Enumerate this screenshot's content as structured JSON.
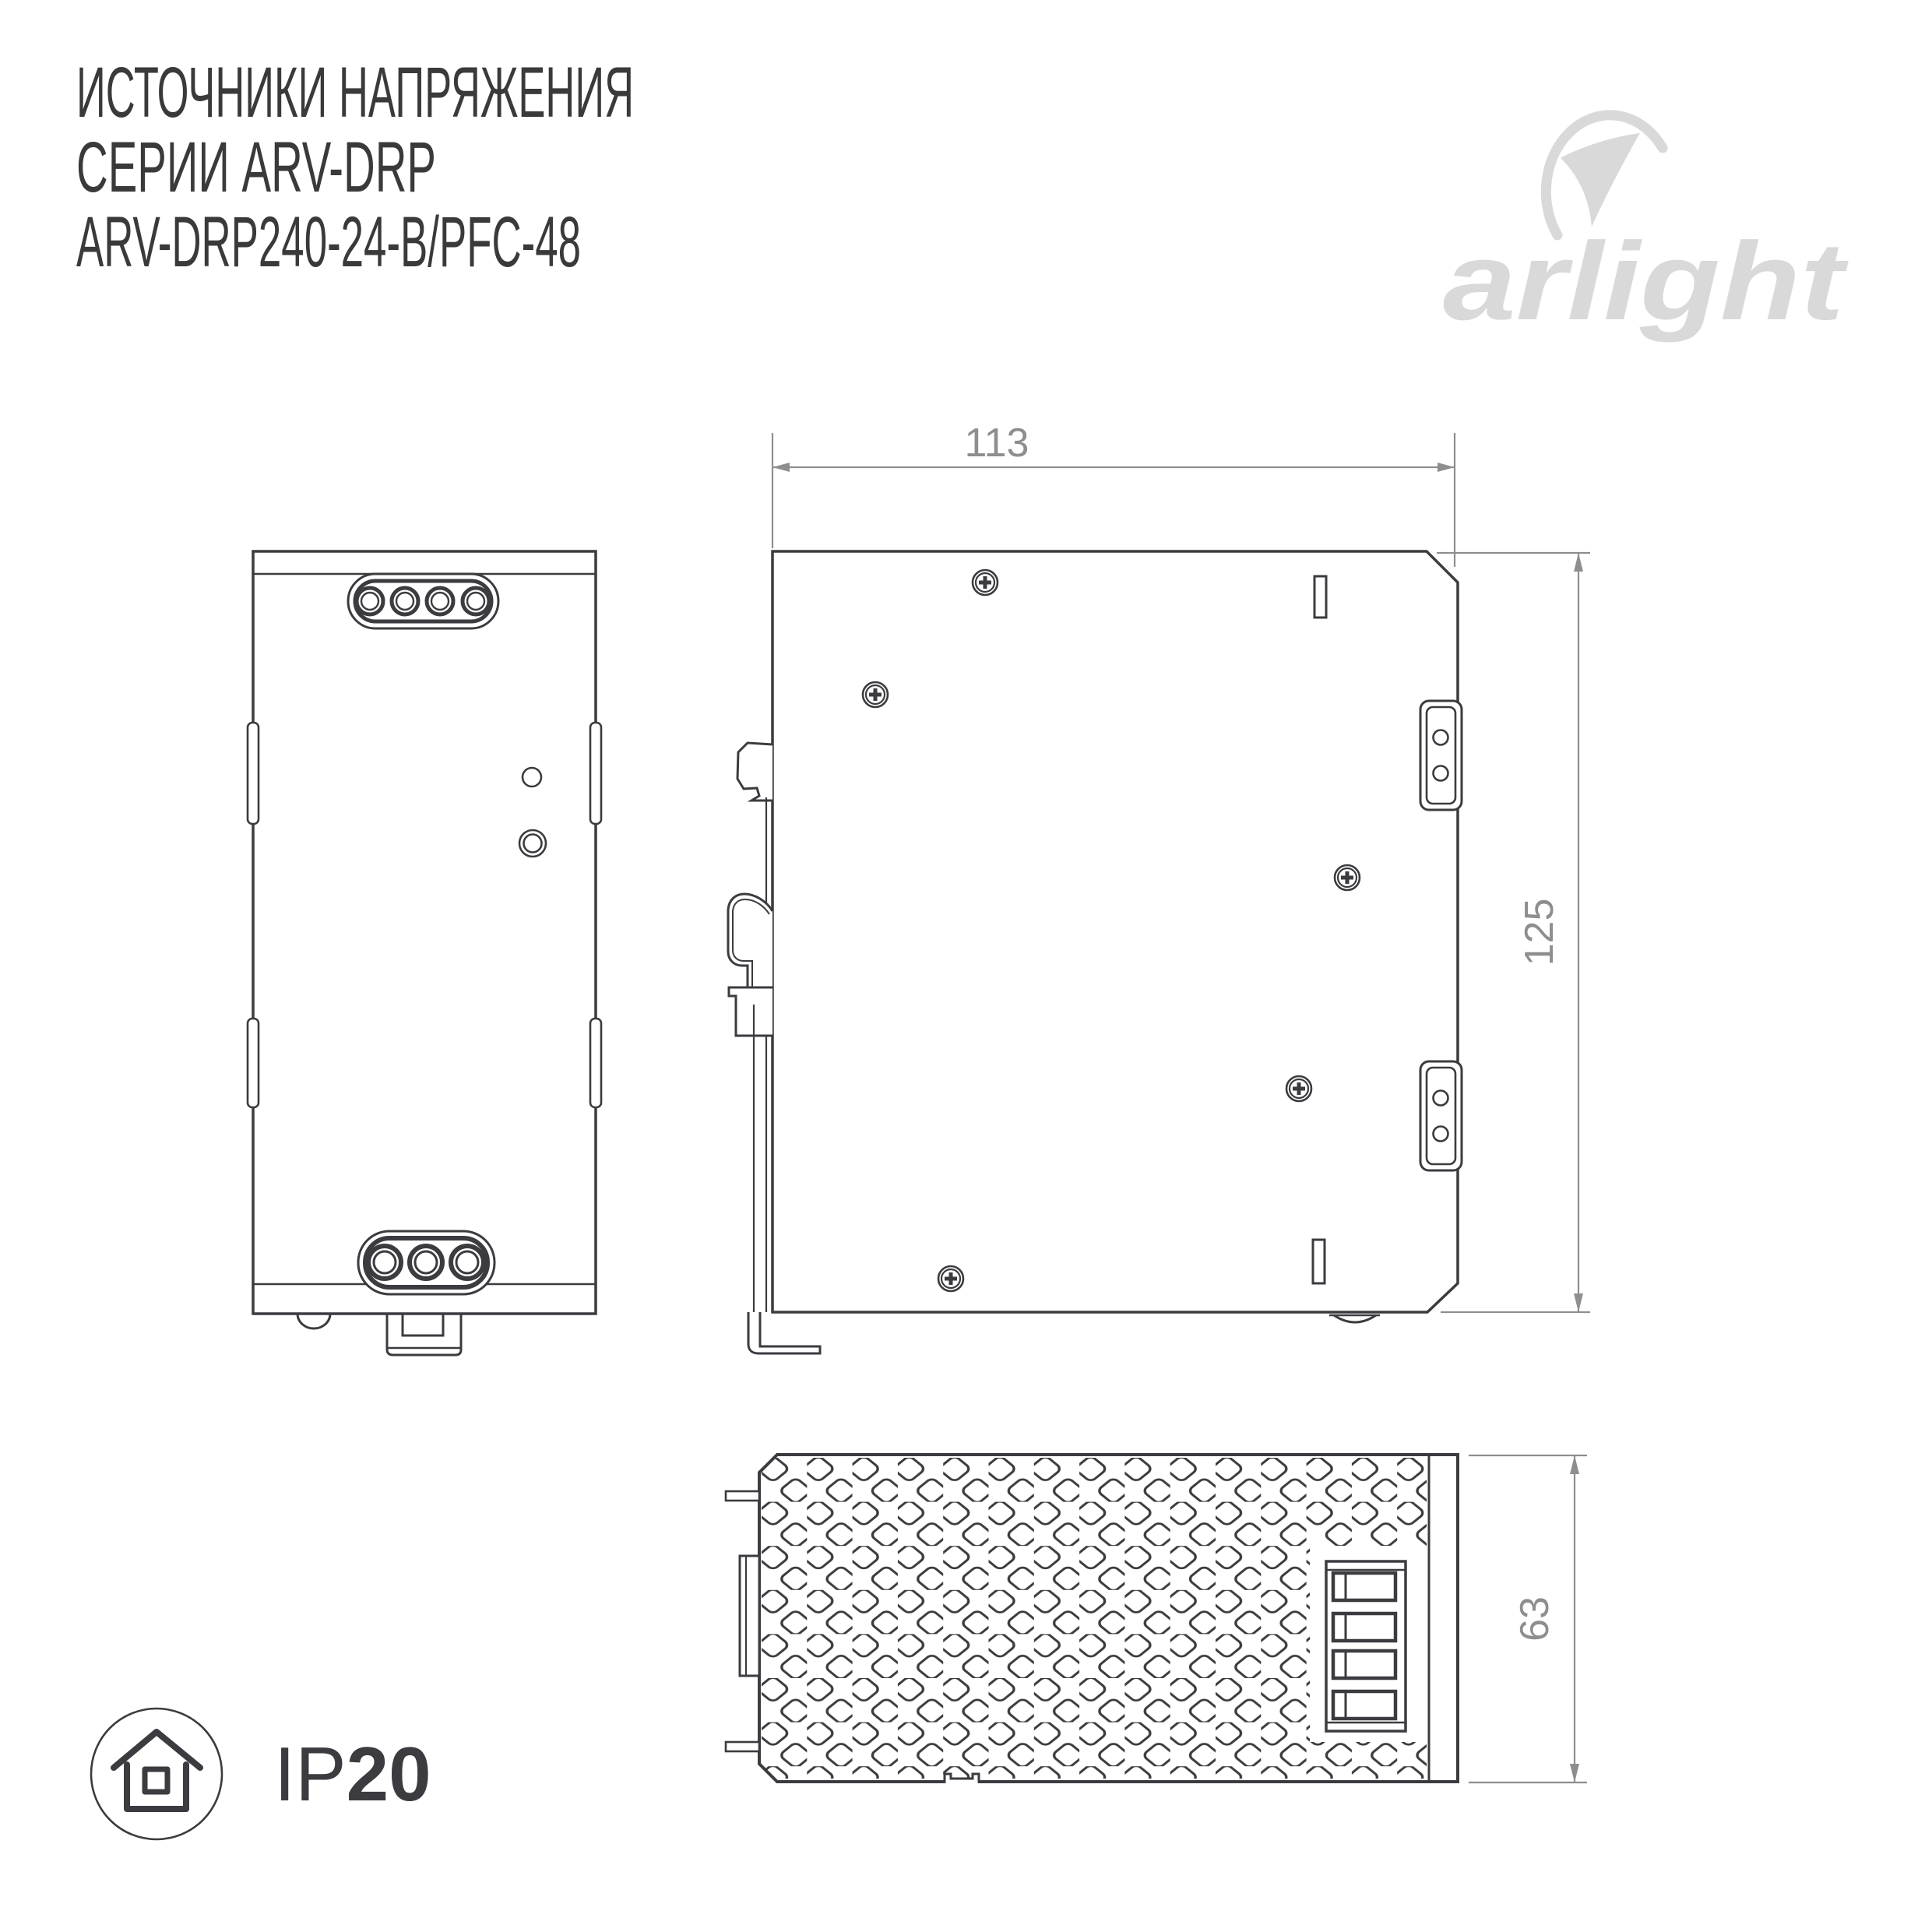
{
  "title": {
    "line1": "ИСТОЧНИКИ НАПРЯЖЕНИЯ",
    "line2": "СЕРИИ ARV-DRP",
    "line3": "ARV-DRP240-24-B/PFC-48"
  },
  "logo": {
    "brand": "arlight"
  },
  "dimensions": {
    "width_mm": "113",
    "height_mm": "125",
    "depth_mm": "63"
  },
  "rating": {
    "prefix": "IP",
    "value": "20"
  },
  "icons": {
    "logo": "arlight-swoosh-icon",
    "ip_rating": "house-in-circle-icon",
    "screws": "phillips-screw-icon"
  },
  "colors": {
    "line": "#3b3b40",
    "dimension": "#8e8e8e",
    "logo": "#d9d9d9",
    "text": "#3a3a3a"
  }
}
